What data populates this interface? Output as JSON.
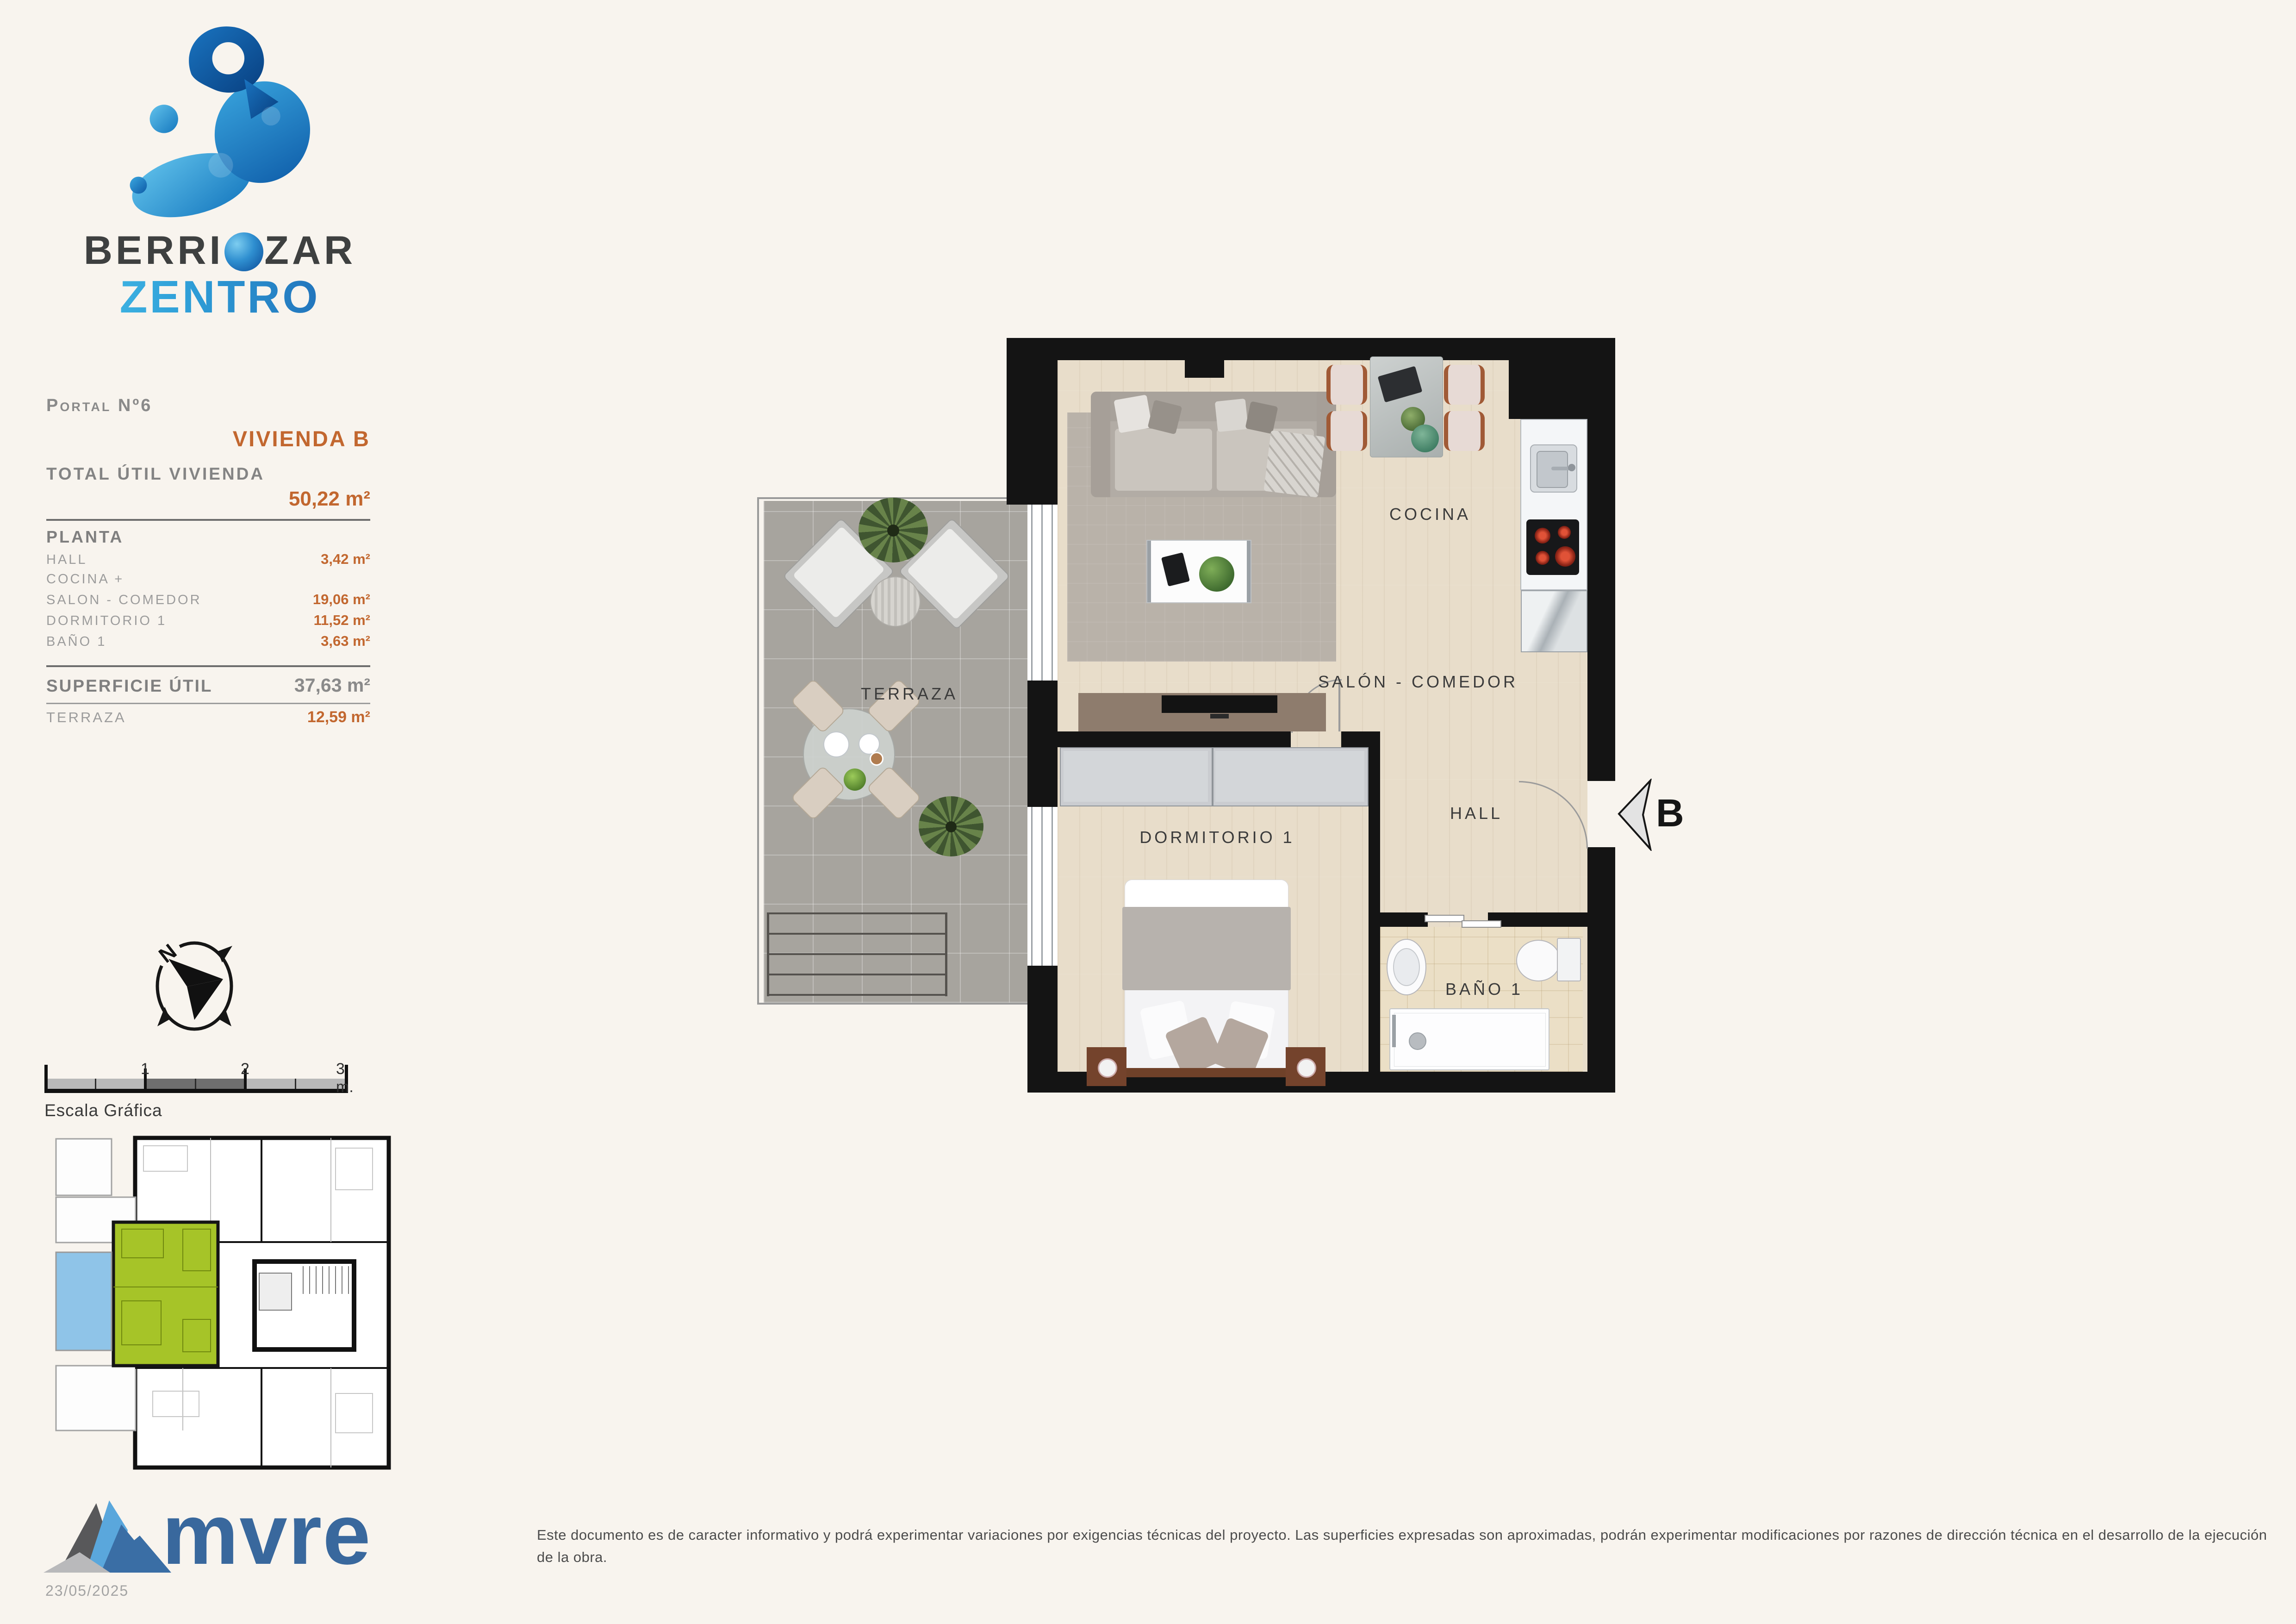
{
  "brand": {
    "line1_pre": "BERRI",
    "line1_post": "ZAR",
    "line2": "ZENTRO"
  },
  "info": {
    "portal": "Portal Nº6",
    "vivienda": "VIVIENDA B",
    "total_label": "TOTAL ÚTIL VIVIENDA",
    "total_value": "50,22 m²",
    "planta_label": "PLANTA",
    "rows": [
      {
        "label": "HALL",
        "value": "3,42 m²"
      },
      {
        "label": "COCINA +",
        "value": ""
      },
      {
        "label": "SALON - COMEDOR",
        "value": "19,06 m²"
      },
      {
        "label": "DORMITORIO 1",
        "value": "11,52 m²"
      },
      {
        "label": "BAÑO 1",
        "value": "3,63 m²"
      }
    ],
    "superficie_label": "SUPERFICIE ÚTIL",
    "superficie_value": "37,63 m²",
    "terraza_label": "TERRAZA",
    "terraza_value": "12,59 m²"
  },
  "plan": {
    "rooms": {
      "terraza": "TERRAZA",
      "cocina": "COCINA",
      "salon": "SALÓN - COMEDOR",
      "hall": "HALL",
      "dormitorio": "DORMITORIO 1",
      "bano": "BAÑO 1"
    },
    "entrance_letter": "B"
  },
  "compass": {
    "north": "N"
  },
  "scale": {
    "t1": "1",
    "t2": "2",
    "t3": "3 m.",
    "caption": "Escala Gráfica"
  },
  "footer": {
    "logo": "mvre",
    "date": "23/05/2025",
    "disclaimer": "Este documento es de caracter informativo y podrá experimentar variaciones por exigencias técnicas del proyecto. Las superficies expresadas son aproximadas, podrán experimentar modificaciones por razones de dirección técnica en el desarrollo de la ejecución de la obra."
  },
  "colors": {
    "background": "#f8f4ee",
    "accent_orange": "#c2672f",
    "text_gray": "#8a8a8a",
    "brand_dark": "#3e4040",
    "brand_cyan": "#49c2ea",
    "brand_blue": "#1b5fae",
    "unit_green": "#a6c428",
    "terrace_blue": "#8fc4e8",
    "mvre_blue": "#39689d",
    "wall_black": "#141414"
  }
}
